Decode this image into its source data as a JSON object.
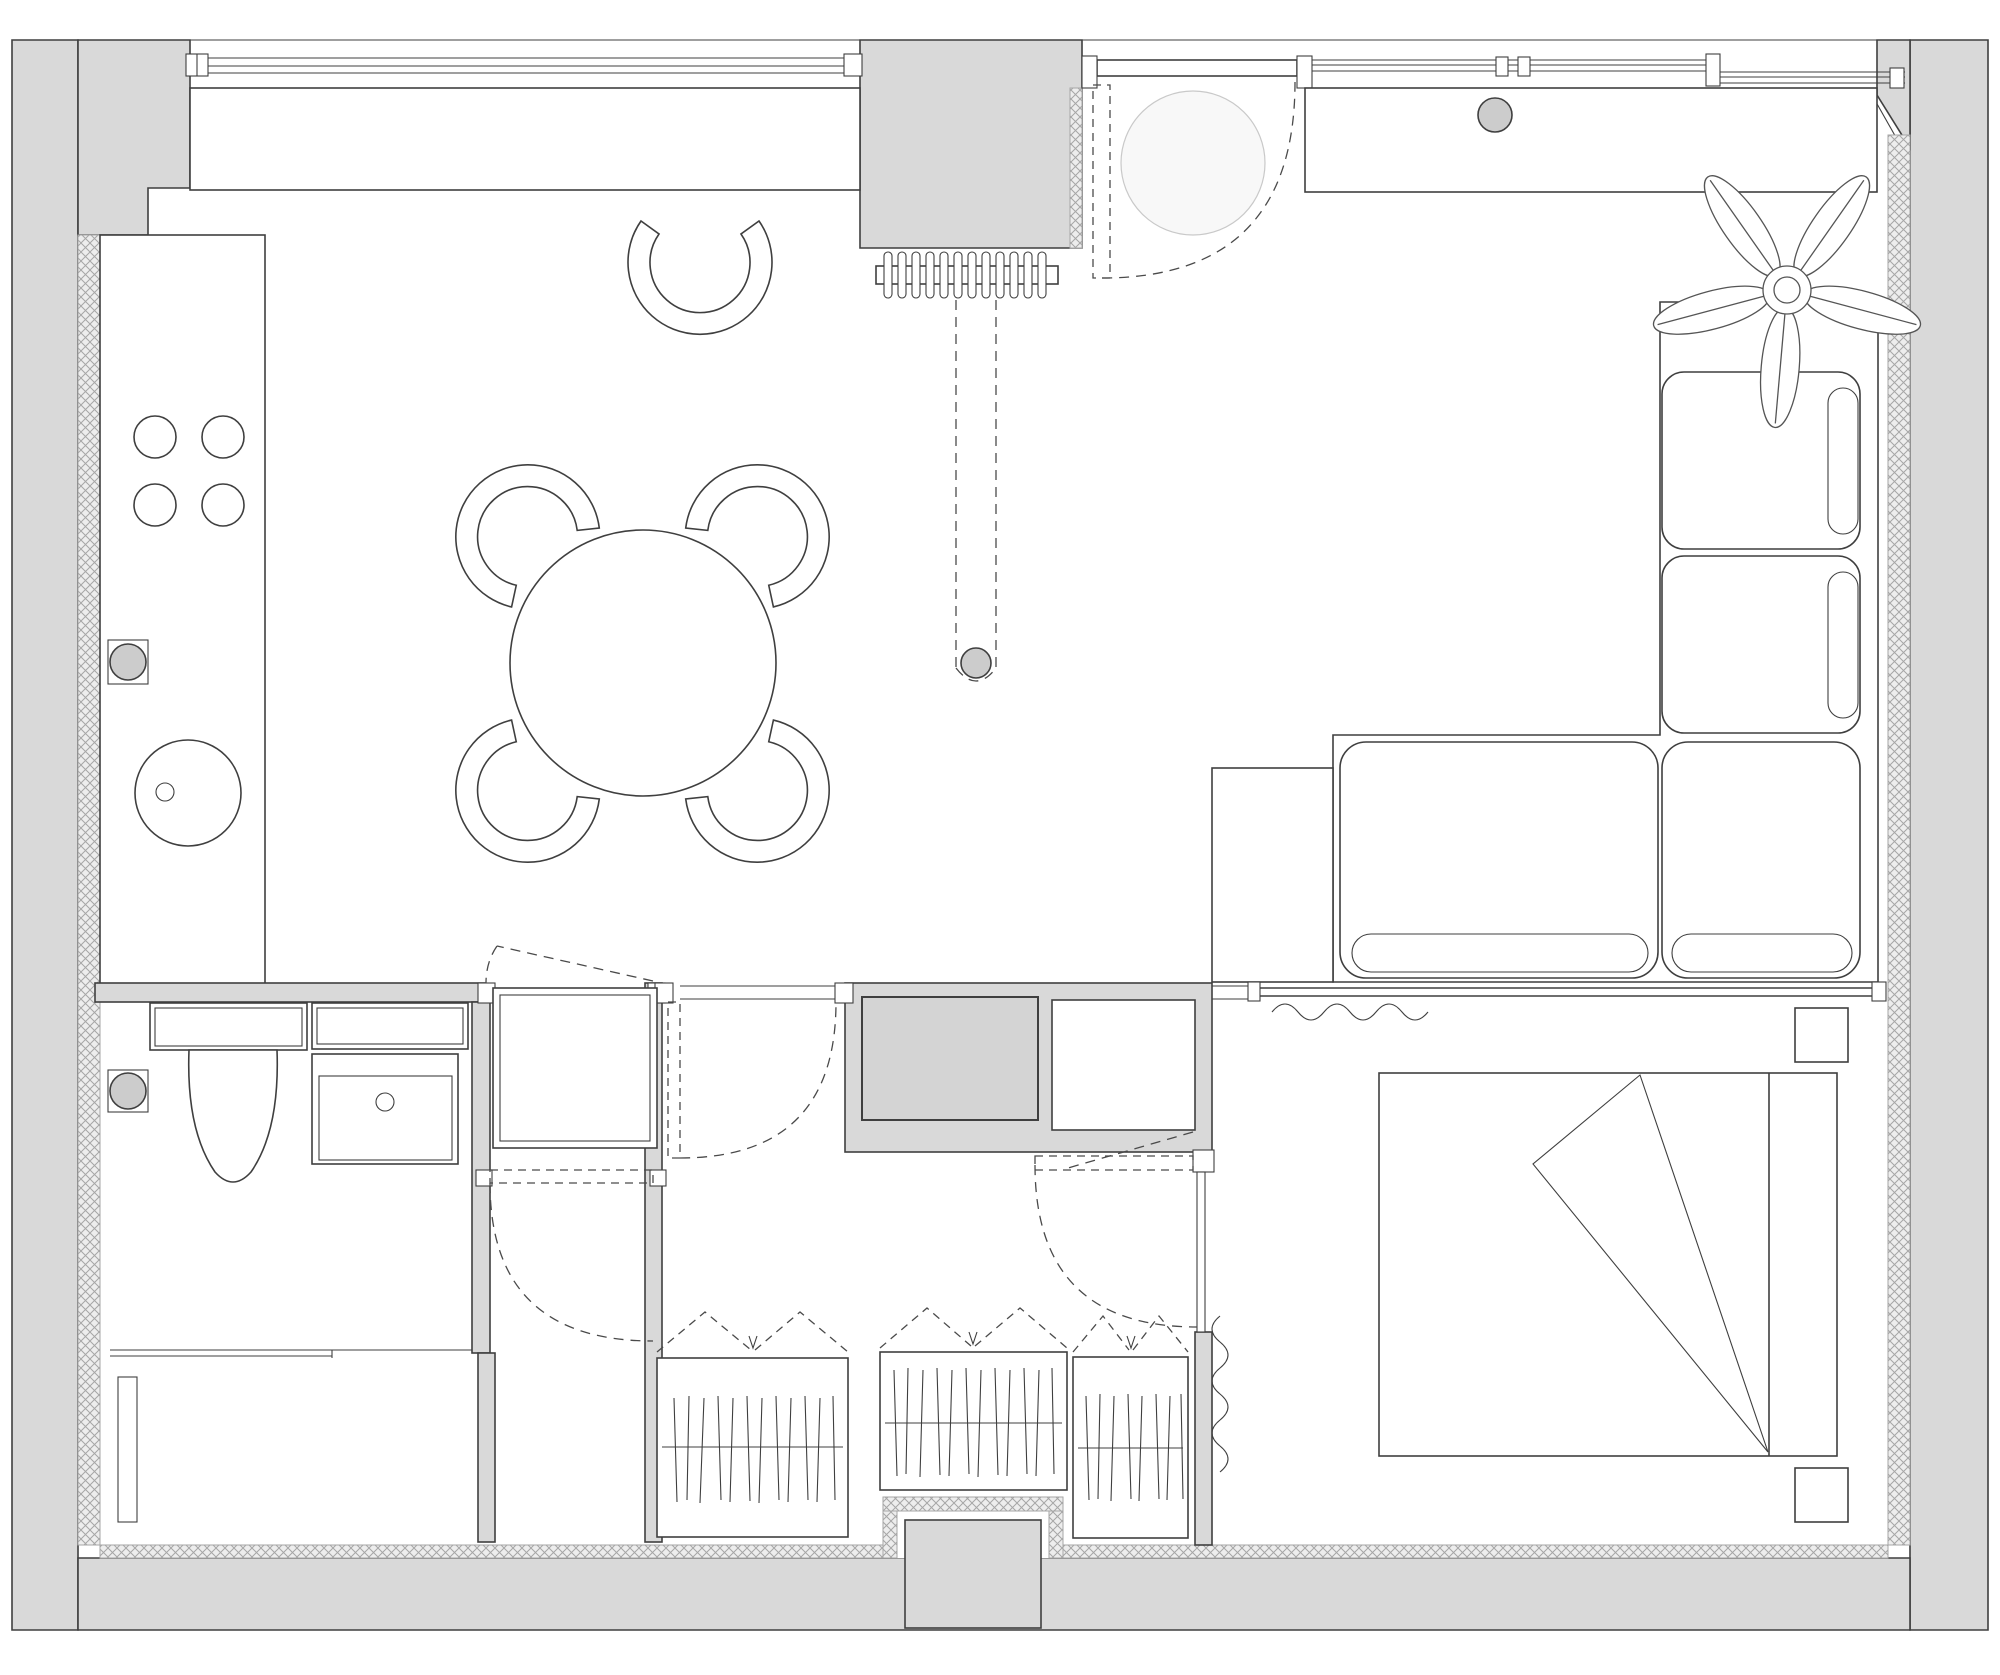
{
  "document": {
    "type": "apartment floor plan drawing",
    "style": "monochrome line drawing, gray filled walls, hatched insulation layer",
    "visible_text": "none"
  },
  "colors": {
    "background": "#ffffff",
    "wall_fill": "#d9d9d9",
    "line": "#3f3f3f",
    "dashed_line": "#4a4a4a",
    "insulation_bg": "#ededed",
    "insulation_stroke": "#a6a6a6",
    "fixture_fill": "#cccccc",
    "washer_fill": "#d4d4d4",
    "ceiling_light_fill": "#f8f8f8"
  },
  "rooms": [
    {
      "name": "kitchen-living-dining",
      "furniture": [
        "window-counter-desk",
        "tall-kitchen-counter",
        "cooktop-four-burners",
        "round-sink",
        "wall-tap",
        "round-dining-table",
        "dining-chairs (4)",
        "desk-chair",
        "radiator",
        "pendant-lamp-on-track",
        "corner-sofa",
        "sofa-side-table",
        "potted-plant"
      ]
    },
    {
      "name": "entry",
      "furniture": [
        "entry-door-with-swing",
        "ceiling-light",
        "entry-closet",
        "closet-knob"
      ]
    },
    {
      "name": "bathroom",
      "furniture": [
        "toilet",
        "wall-shelf",
        "washbasin-cabinet",
        "wall-drain-fixture"
      ]
    },
    {
      "name": "hallway",
      "furniture": [
        "shower-cabin",
        "utility-closet-washer",
        "utility-closet-shelf",
        "swing-door-living",
        "swing-door-hall",
        "swing-door-corridor"
      ]
    },
    {
      "name": "wardrobe-corridor",
      "furniture": [
        "wardrobe-section-1",
        "wardrobe-section-2",
        "wardrobe-section-3",
        "folding-door-symbols",
        "exterior-niche"
      ]
    },
    {
      "name": "bedroom",
      "furniture": [
        "double-bed",
        "folded-blanket",
        "headboard",
        "nightstand-top",
        "nightstand-bottom",
        "vertical-curtain",
        "glazed-partition",
        "partition-curtain",
        "swing-door-bedroom"
      ]
    },
    {
      "name": "storage-room",
      "furniture": [
        "wall-shelf-strip"
      ]
    }
  ],
  "counts": {
    "burners": 4,
    "dining_chairs": 4,
    "desk_chairs": 1,
    "wardrobe_sections": 3,
    "sofa_seat_cushions": 4,
    "sofa_bolster_pillows": 4,
    "nightstands": 2,
    "hinged_doors": 5,
    "windows": 3,
    "plant_leaves": 5
  }
}
